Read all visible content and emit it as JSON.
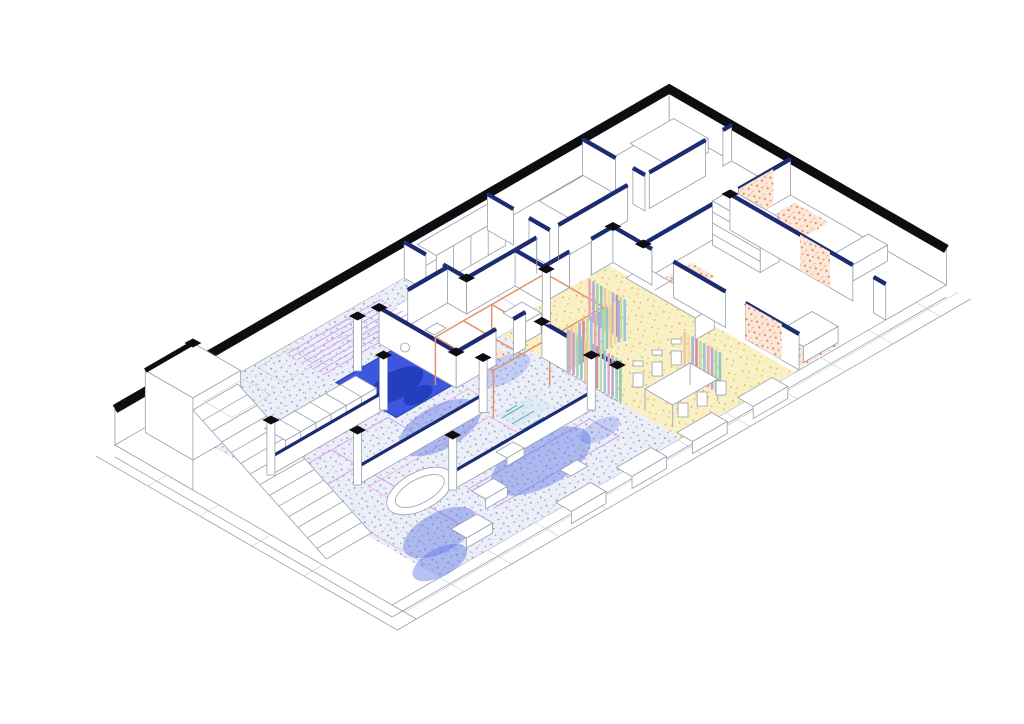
{
  "drawing": {
    "type": "axonometric-floor-plan",
    "description_names": [
      "open-living-zone",
      "pool",
      "kitchen-dining-zone",
      "bedroom-zones",
      "stair-core",
      "terrace-edge"
    ]
  },
  "palette": {
    "background": "#ffffff",
    "white": "#ffffff",
    "line_black": "#0d0d12",
    "line_navy": "#1c2b72",
    "pool_edge": "#2a3fa8",
    "line_gray": "#9aa0ae",
    "line_light": "#c6cad4",
    "floor_blue_base": "#edeff8",
    "floor_blue_dot": "#93a0cf",
    "floor_blue_dot2": "#b9c2e4",
    "wash_blue": "#5b78e4",
    "pool_blue": "#3a57de",
    "pool_dark": "#2038b8",
    "floor_yellow_base": "#f9f0c6",
    "floor_yellow_dot": "#dcbe4e",
    "floor_yellow_dot2": "#efdc8e",
    "floor_orange_base": "#fce8da",
    "floor_orange_dot": "#e1884e",
    "floor_orange_dot2": "#f0b48c",
    "violet": "#cf9fe8",
    "pink": "#efb3da",
    "teal": "#4aa8b8",
    "teal_fill": "#cfe8ee",
    "frame_orange": "#e2906a",
    "rainbow": [
      "#e9a9b6",
      "#b7a9d9",
      "#a9d2b2",
      "#8bc9c2",
      "#f0c9a2",
      "#efe0a2",
      "#a6b2e2",
      "#d78d9d",
      "#c2dca6",
      "#9bc4e6"
    ]
  }
}
